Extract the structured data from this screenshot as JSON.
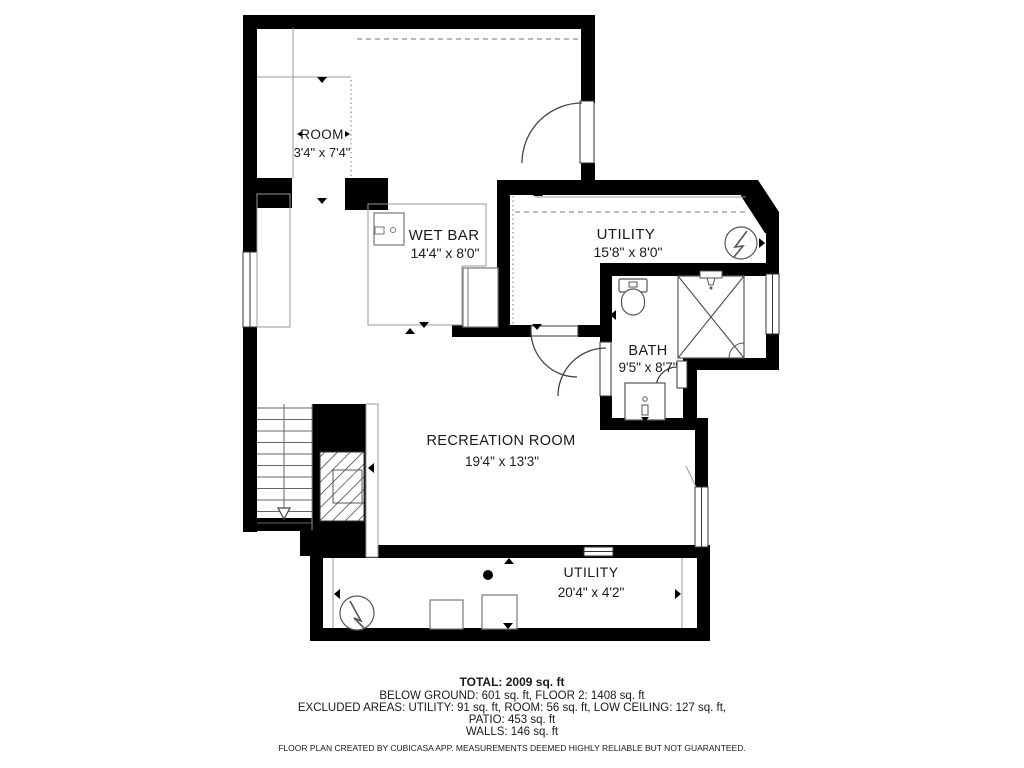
{
  "plan": {
    "rooms": [
      {
        "name": "ROOM",
        "dims": "3'4\" x 7'4\""
      },
      {
        "name": "WET BAR",
        "dims": "14'4\" x 8'0\""
      },
      {
        "name": "UTILITY",
        "dims": "15'8\" x 8'0\""
      },
      {
        "name": "BATH",
        "dims": "9'5\" x 8'7\""
      },
      {
        "name": "RECREATION ROOM",
        "dims": "19'4\" x 13'3\""
      },
      {
        "name": "UTILITY",
        "dims": "20'4\" x 4'2\""
      }
    ],
    "colors": {
      "wall": "#000000",
      "fixture": "#555555",
      "thin_line": "#999999",
      "text": "#1a1a1a"
    }
  },
  "summary": {
    "total": "TOTAL: 2009 sq. ft",
    "breakdown": "BELOW GROUND: 601 sq. ft, FLOOR 2: 1408 sq. ft",
    "excluded_1": "EXCLUDED AREAS: UTILITY: 91 sq. ft, ROOM: 56 sq. ft, LOW CEILING: 127 sq. ft,",
    "excluded_2": "PATIO: 453 sq. ft",
    "walls": "WALLS: 146 sq. ft"
  },
  "footer": "FLOOR PLAN CREATED BY CUBICASA APP. MEASUREMENTS DEEMED HIGHLY RELIABLE BUT NOT GUARANTEED."
}
